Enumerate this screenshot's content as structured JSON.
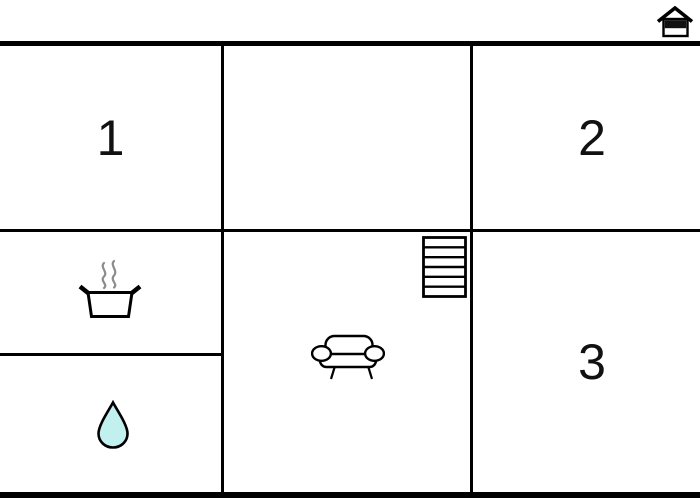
{
  "plan": {
    "type": "floor-plan",
    "rooms": [
      {
        "id": "room-1",
        "label": "1",
        "area": "top-left"
      },
      {
        "id": "room-top-middle",
        "label": "",
        "area": "top-middle"
      },
      {
        "id": "room-2",
        "label": "2",
        "area": "top-right"
      },
      {
        "id": "kitchen",
        "label": "",
        "icon": "cooking-pot-icon",
        "area": "middle-left"
      },
      {
        "id": "bathroom",
        "label": "",
        "icon": "water-drop-icon",
        "area": "bottom-left"
      },
      {
        "id": "living-room",
        "label": "",
        "icons": [
          "sofa-icon",
          "stairs-icon"
        ],
        "area": "bottom-middle"
      },
      {
        "id": "room-3",
        "label": "3",
        "area": "bottom-right"
      }
    ],
    "entrance_marker": "house-icon",
    "stairs_steps": 6,
    "colors": {
      "background": "#ffffff",
      "walls": "#000000",
      "label_text": "#111111",
      "water_drop_fill": "#c2f0ee",
      "steam_gray": "#8c8c8c",
      "house_band": "#111111"
    }
  }
}
